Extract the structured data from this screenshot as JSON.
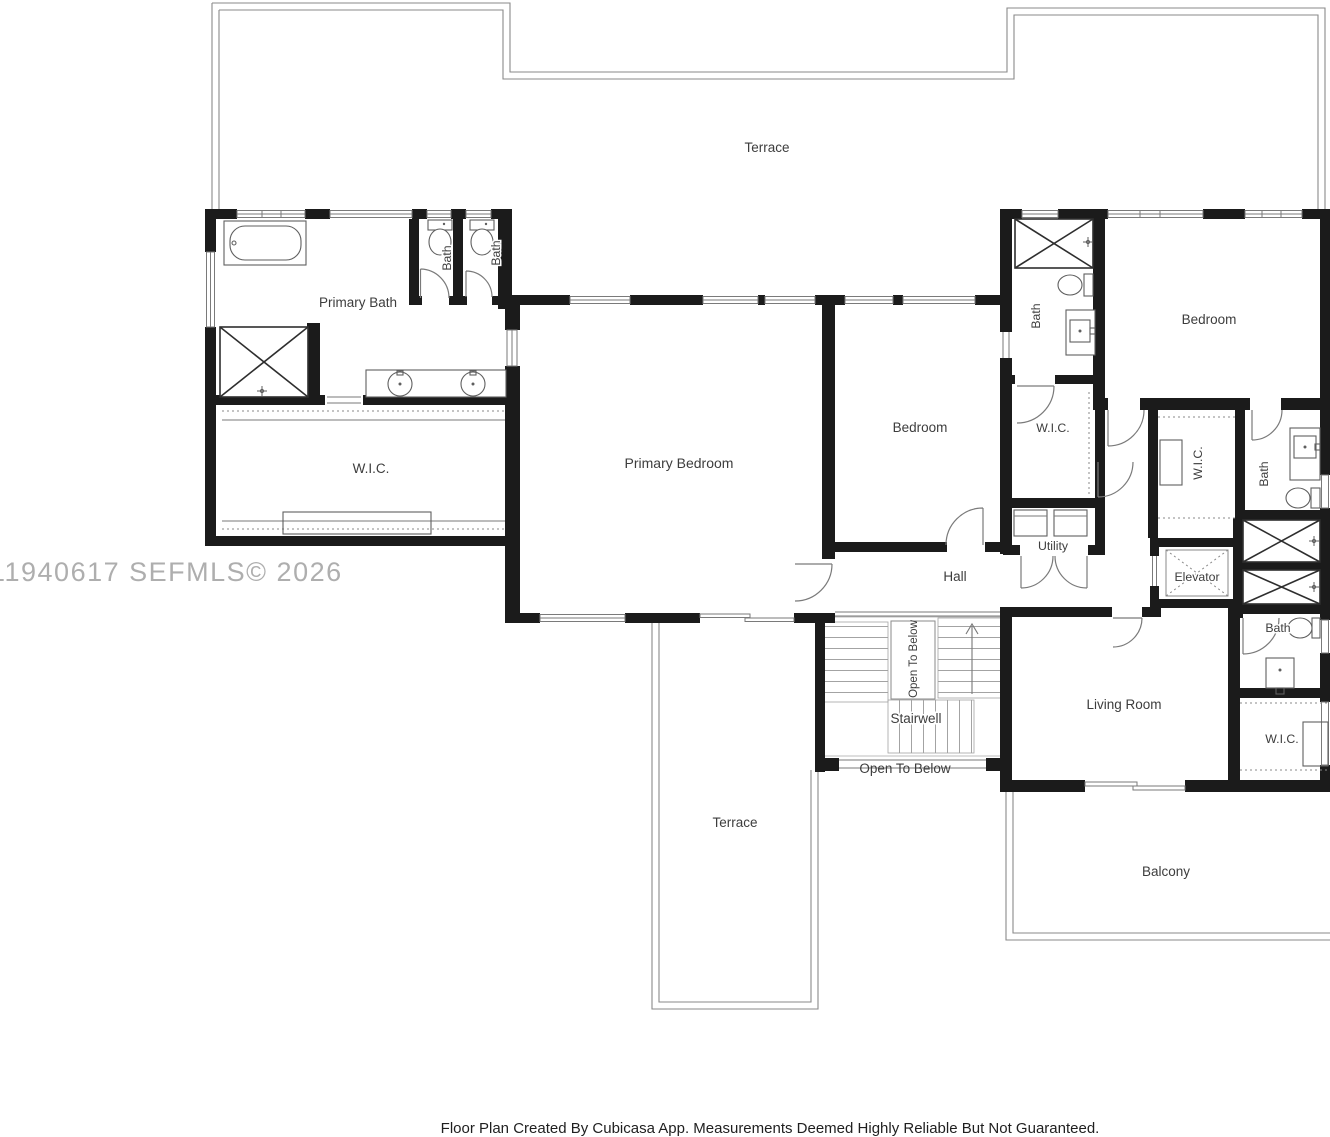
{
  "floorplan": {
    "labels": {
      "terrace_top": "Terrace",
      "primary_bath": "Primary Bath",
      "bath_small_left": "Bath",
      "bath_small_right": "Bath",
      "wic_left": "W.I.C.",
      "primary_bedroom": "Primary Bedroom",
      "bedroom_center": "Bedroom",
      "bedroom_right": "Bedroom",
      "bath_top_right": "Bath",
      "wic_center": "W.I.C.",
      "utility": "Utility",
      "wic_right": "W.I.C.",
      "bath_right": "Bath",
      "elevator": "Elevator",
      "hall": "Hall",
      "stairwell": "Stairwell",
      "open_to_below_vertical": "Open To Below",
      "open_to_below_bottom": "Open To Below",
      "bath_bottom_right": "Bath",
      "wic_bottom_right": "W.I.C.",
      "living_room": "Living Room",
      "terrace_bottom": "Terrace",
      "balcony": "Balcony"
    },
    "watermark": "11940617  SEFMLS© 2026",
    "footer": "Floor Plan Created By Cubicasa App. Measurements Deemed Highly Reliable But Not Guaranteed.",
    "colors": {
      "wall": "#1b1b1b",
      "thin_line": "#8a8a8a",
      "fixture_line": "#5f5f5f",
      "label_text": "#3d3d3d",
      "watermark_text": "#aeaeae",
      "footer_text": "#1f1f1f"
    }
  }
}
